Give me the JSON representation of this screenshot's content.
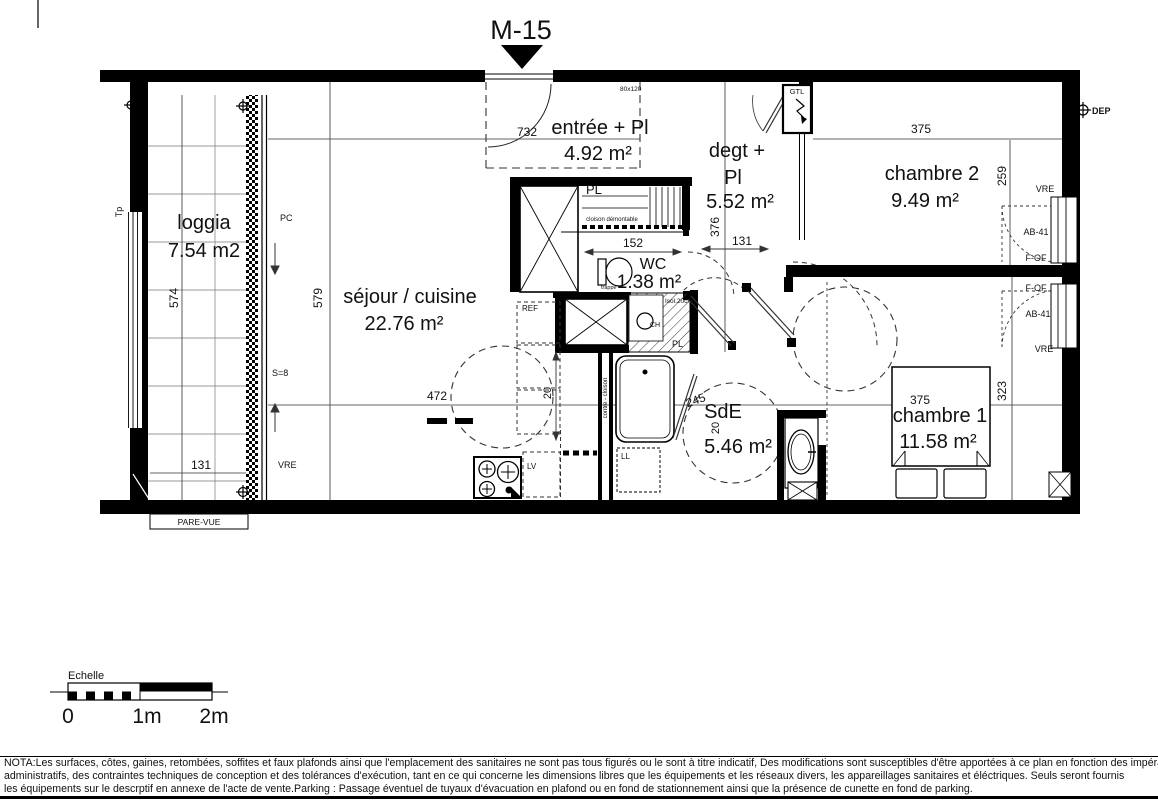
{
  "title": "M-15",
  "rooms": {
    "entree": {
      "name": "entrée + Pl",
      "area": "4.92 m²"
    },
    "degt": {
      "name_line1": "degt +",
      "name_line2": "Pl",
      "area": "5.52 m²"
    },
    "chambre2": {
      "name": "chambre 2",
      "area": "9.49 m²"
    },
    "loggia": {
      "name": "loggia",
      "area": "7.54 m2"
    },
    "sejour": {
      "name": "séjour / cuisine",
      "area": "22.76 m²"
    },
    "wc": {
      "name": "WC",
      "area": "1.38 m²"
    },
    "sde": {
      "name": "SdE",
      "area": "5.46 m²"
    },
    "chambre1": {
      "name": "chambre 1",
      "area": "11.58 m²"
    }
  },
  "dims": {
    "sejour_w_732": "732",
    "closet_152": "152",
    "degt_131": "131",
    "ch2_375": "375",
    "ch2_259": "259",
    "degt_376": "376",
    "sejour_579": "579",
    "loggia_574": "574",
    "loggia_131": "131",
    "sejour_472": "472",
    "ch1_375": "375",
    "ch1_323": "323",
    "sde_245": "245",
    "kitchen_20": "20",
    "sde_20": "20"
  },
  "labels": {
    "tp": "Tp",
    "pc": "PC",
    "s8": "S=8",
    "vre": "VRE",
    "pare_vue": "PARE-VUE",
    "pl": "PL",
    "cloison_demontable": "cloison démontable",
    "size_hatch": "80x120",
    "trappe": "trappe",
    "ref": "REF",
    "isol": "Isol.20cm",
    "ch": "CH",
    "contre_cloison": "contre - cloison",
    "lv": "LV",
    "ll": "LL",
    "gtl": "GTL",
    "dep": "DEP"
  },
  "windows": {
    "ch2": [
      "VRE",
      "AB-41",
      "F-OF"
    ],
    "ch1": [
      "F-OF",
      "AB-41",
      "VRE"
    ]
  },
  "scalebar": {
    "label": "Echelle",
    "t0": "0",
    "t1": "1m",
    "t2": "2m"
  },
  "nota": [
    "NOTA:Les surfaces, côtes, gaines, retombées, soffites et faux plafonds ainsi que l'emplacement des sanitaires ne sont pas tous figurés ou le sont à titre indicatif, Des modifications sont susceptibles d'être apportées à ce plan en fonction des impératifs",
    "administratifs, des contraintes techniques de conception et des tolérances d'exécution, tant en ce qui concerne les dimensions libres que les équipements  et les réseaux divers, les appareillages sanitaires et éléctriques. Seuls seront fournis",
    "les équipements sur le descrptif en annexe de l'acte de vente.Parking : Passage éventuel de tuyaux d'évacuation en plafond ou en fond de stationnement ainsi que la présence de cunette en fond de parking."
  ]
}
